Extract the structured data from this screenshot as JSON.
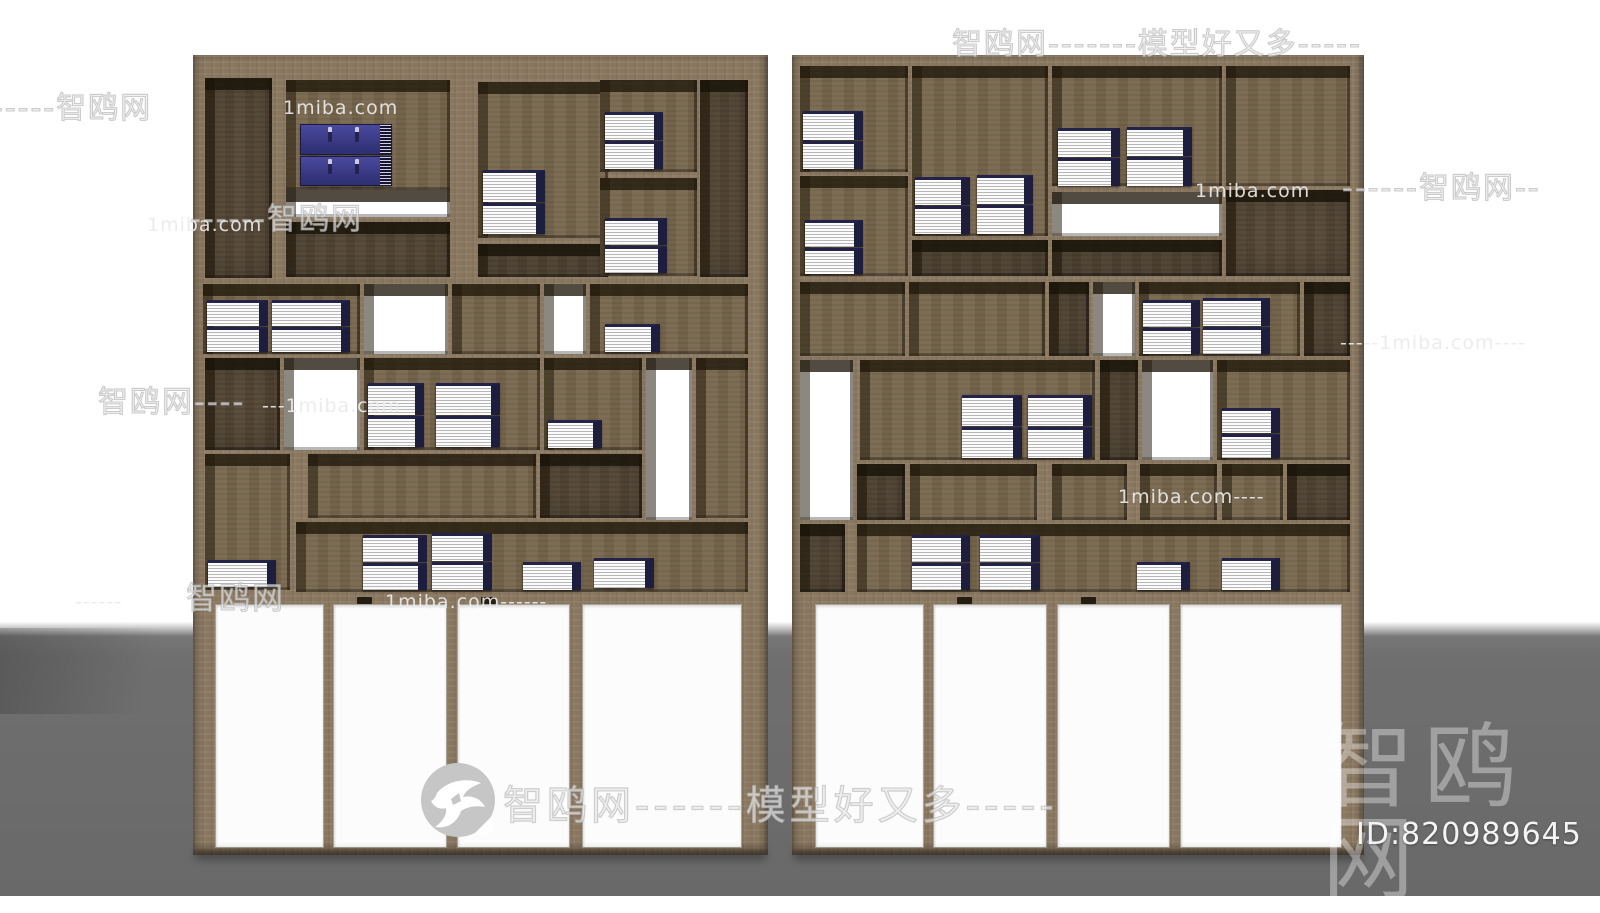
{
  "scene": {
    "width": 1600,
    "height": 896,
    "floor_top": 622,
    "colors": {
      "wall": "#ffffff",
      "floor": "#6f6f6f",
      "wood_frame": "#8c7a63",
      "wood_back": "#79684f",
      "wood_dark": "#5a4c3a",
      "book_cover_navy": "#1d1d3e",
      "book_pages": "#fbfbfb",
      "box_blue": "#35357e",
      "watermark_gray": "#ececec",
      "watermark_white": "#ffffff"
    }
  },
  "watermarks": {
    "outline": [
      {
        "x": 952,
        "y": 30,
        "size": 30,
        "text": "智鸥网-------模型好又多-----"
      },
      {
        "x": -8,
        "y": 94,
        "size": 30,
        "text": "-----智鸥网"
      },
      {
        "x": 1342,
        "y": 174,
        "size": 30,
        "text": "------智鸥网--"
      },
      {
        "x": 190,
        "y": 205,
        "size": 30,
        "text": "------智鸥网"
      },
      {
        "x": 98,
        "y": 388,
        "size": 30,
        "text": "智鸥网----"
      },
      {
        "x": 186,
        "y": 584,
        "size": 31,
        "text": "智鸥网"
      }
    ],
    "gray": [
      {
        "x": 283,
        "y": 99,
        "size": 19,
        "text": "1miba.com"
      },
      {
        "x": 147,
        "y": 216,
        "size": 19,
        "text": "1miba.com"
      },
      {
        "x": 1195,
        "y": 182,
        "size": 19,
        "text": "1miba.com"
      },
      {
        "x": 1340,
        "y": 334,
        "size": 19,
        "text": "-----1miba.com----"
      },
      {
        "x": 262,
        "y": 397,
        "size": 19,
        "text": "---1miba.com"
      },
      {
        "x": 1118,
        "y": 488,
        "size": 19,
        "text": "1miba.com----"
      },
      {
        "x": 75,
        "y": 593,
        "size": 19,
        "text": "------"
      },
      {
        "x": 385,
        "y": 593,
        "size": 19,
        "text": "1miba.com------"
      }
    ],
    "badge": {
      "x": 421,
      "y": 763,
      "diameter": 74,
      "text_size": 40,
      "text": "智鸥网------模型好又多-----"
    },
    "footer": {
      "logo_text": "智鸥网",
      "logo_x": 1322,
      "logo_y": 722,
      "logo_size": 92,
      "id_text": "ID:820989645",
      "id_x": 1356,
      "id_y": 820,
      "id_size": 30
    }
  },
  "shelves": [
    {
      "name": "left-shelf",
      "x": 193,
      "y": 55,
      "w": 575,
      "h": 800,
      "compartments": [
        {
          "x": 12,
          "y": 23,
          "w": 67,
          "h": 200,
          "back": "dark"
        },
        {
          "x": 93,
          "y": 25,
          "w": 164,
          "h": 110,
          "back": "wood",
          "items": [
            {
              "t": "boxes2",
              "x": 14,
              "y": 44,
              "w": 92,
              "h": 62
            }
          ]
        },
        {
          "x": 93,
          "y": 135,
          "w": 164,
          "h": 27,
          "back": "white"
        },
        {
          "x": 93,
          "y": 167,
          "w": 164,
          "h": 55,
          "back": "dark"
        },
        {
          "x": 285,
          "y": 27,
          "w": 130,
          "h": 156,
          "back": "wood",
          "items": [
            {
              "t": "books2",
              "x": 5,
              "y": 88,
              "w": 62,
              "h": 64
            }
          ]
        },
        {
          "x": 285,
          "y": 189,
          "w": 130,
          "h": 33,
          "back": "dark"
        },
        {
          "x": 407,
          "y": 25,
          "w": 97,
          "h": 92,
          "back": "wood",
          "items": [
            {
              "t": "books2",
              "x": 5,
              "y": 32,
              "w": 58,
              "h": 57
            }
          ]
        },
        {
          "x": 407,
          "y": 123,
          "w": 97,
          "h": 98,
          "back": "wood",
          "items": [
            {
              "t": "books2",
              "x": 5,
              "y": 40,
              "w": 62,
              "h": 55
            }
          ]
        },
        {
          "x": 507,
          "y": 25,
          "w": 48,
          "h": 197,
          "back": "dark"
        },
        {
          "x": 10,
          "y": 229,
          "w": 157,
          "h": 70,
          "back": "wood",
          "items": [
            {
              "t": "books2",
              "x": 4,
              "y": 16,
              "w": 61,
              "h": 52
            },
            {
              "t": "books2",
              "x": 69,
              "y": 16,
              "w": 78,
              "h": 52
            }
          ]
        },
        {
          "x": 171,
          "y": 229,
          "w": 84,
          "h": 70,
          "back": "white"
        },
        {
          "x": 259,
          "y": 229,
          "w": 88,
          "h": 70,
          "back": "wood"
        },
        {
          "x": 351,
          "y": 229,
          "w": 42,
          "h": 70,
          "back": "white"
        },
        {
          "x": 397,
          "y": 229,
          "w": 158,
          "h": 70,
          "back": "wood",
          "items": [
            {
              "t": "books1",
              "x": 15,
              "y": 40,
              "w": 55,
              "h": 28
            }
          ]
        },
        {
          "x": 12,
          "y": 303,
          "w": 75,
          "h": 92,
          "back": "dark"
        },
        {
          "x": 91,
          "y": 303,
          "w": 76,
          "h": 92,
          "back": "white"
        },
        {
          "x": 171,
          "y": 303,
          "w": 176,
          "h": 92,
          "back": "wood",
          "items": [
            {
              "t": "books2",
              "x": 4,
              "y": 25,
              "w": 56,
              "h": 64
            },
            {
              "t": "books2",
              "x": 72,
              "y": 25,
              "w": 64,
              "h": 64
            }
          ]
        },
        {
          "x": 351,
          "y": 303,
          "w": 98,
          "h": 92,
          "back": "wood",
          "items": [
            {
              "t": "books1",
              "x": 4,
              "y": 62,
              "w": 54,
              "h": 28
            }
          ]
        },
        {
          "x": 453,
          "y": 303,
          "w": 46,
          "h": 162,
          "back": "white"
        },
        {
          "x": 503,
          "y": 303,
          "w": 52,
          "h": 160,
          "back": "wood"
        },
        {
          "x": 12,
          "y": 399,
          "w": 85,
          "h": 136,
          "back": "wood",
          "items": [
            {
              "t": "books1",
              "x": 3,
              "y": 106,
              "w": 68,
              "h": 27
            }
          ]
        },
        {
          "x": 115,
          "y": 399,
          "w": 228,
          "h": 64,
          "back": "wood"
        },
        {
          "x": 347,
          "y": 399,
          "w": 102,
          "h": 64,
          "back": "dark"
        },
        {
          "x": 103,
          "y": 467,
          "w": 452,
          "h": 70,
          "back": "wood",
          "items": [
            {
              "t": "books2",
              "x": 67,
              "y": 13,
              "w": 64,
              "h": 55
            },
            {
              "t": "books2",
              "x": 136,
              "y": 11,
              "w": 60,
              "h": 57
            },
            {
              "t": "books1",
              "x": 227,
              "y": 40,
              "w": 58,
              "h": 28
            },
            {
              "t": "books1",
              "x": 298,
              "y": 36,
              "w": 60,
              "h": 30
            }
          ]
        }
      ],
      "doors": {
        "y": 537,
        "h": 263,
        "panels": [
          {
            "x": 22,
            "w": 107
          },
          {
            "x": 140,
            "w": 112
          },
          {
            "x": 264,
            "w": 111
          },
          {
            "x": 389,
            "w": 158
          }
        ],
        "notch_panels": [
          1,
          2
        ]
      }
    },
    {
      "name": "right-shelf",
      "x": 792,
      "y": 55,
      "w": 572,
      "h": 800,
      "compartments": [
        {
          "x": 8,
          "y": 11,
          "w": 108,
          "h": 106,
          "back": "wood",
          "items": [
            {
              "t": "books2",
              "x": 3,
              "y": 45,
              "w": 60,
              "h": 58
            }
          ]
        },
        {
          "x": 8,
          "y": 121,
          "w": 108,
          "h": 100,
          "back": "wood",
          "items": [
            {
              "t": "books2",
              "x": 5,
              "y": 44,
              "w": 58,
              "h": 54
            }
          ]
        },
        {
          "x": 120,
          "y": 11,
          "w": 136,
          "h": 170,
          "back": "wood",
          "items": [
            {
              "t": "books2",
              "x": 3,
              "y": 111,
              "w": 55,
              "h": 57
            },
            {
              "t": "books2",
              "x": 65,
              "y": 109,
              "w": 56,
              "h": 59
            }
          ]
        },
        {
          "x": 120,
          "y": 185,
          "w": 136,
          "h": 36,
          "back": "dark"
        },
        {
          "x": 260,
          "y": 11,
          "w": 170,
          "h": 120,
          "back": "wood",
          "items": [
            {
              "t": "books2",
              "x": 6,
              "y": 62,
              "w": 62,
              "h": 58
            },
            {
              "t": "books2",
              "x": 75,
              "y": 61,
              "w": 65,
              "h": 59
            }
          ]
        },
        {
          "x": 260,
          "y": 137,
          "w": 170,
          "h": 44,
          "back": "white"
        },
        {
          "x": 260,
          "y": 185,
          "w": 170,
          "h": 36,
          "back": "dark"
        },
        {
          "x": 434,
          "y": 11,
          "w": 124,
          "h": 120,
          "back": "wood"
        },
        {
          "x": 434,
          "y": 135,
          "w": 124,
          "h": 86,
          "back": "dark"
        },
        {
          "x": 8,
          "y": 227,
          "w": 105,
          "h": 74,
          "back": "wood"
        },
        {
          "x": 117,
          "y": 227,
          "w": 136,
          "h": 74,
          "back": "wood"
        },
        {
          "x": 257,
          "y": 227,
          "w": 40,
          "h": 74,
          "back": "dark"
        },
        {
          "x": 301,
          "y": 227,
          "w": 42,
          "h": 74,
          "back": "white"
        },
        {
          "x": 347,
          "y": 227,
          "w": 161,
          "h": 74,
          "back": "wood",
          "items": [
            {
              "t": "books2",
              "x": 4,
              "y": 18,
              "w": 57,
              "h": 54
            },
            {
              "t": "books2",
              "x": 64,
              "y": 16,
              "w": 67,
              "h": 56
            }
          ]
        },
        {
          "x": 512,
          "y": 227,
          "w": 46,
          "h": 74,
          "back": "dark"
        },
        {
          "x": 8,
          "y": 305,
          "w": 53,
          "h": 160,
          "back": "white"
        },
        {
          "x": 68,
          "y": 305,
          "w": 235,
          "h": 100,
          "back": "wood",
          "items": [
            {
              "t": "books2",
              "x": 102,
              "y": 35,
              "w": 60,
              "h": 63
            },
            {
              "t": "books2",
              "x": 168,
              "y": 35,
              "w": 64,
              "h": 63
            }
          ]
        },
        {
          "x": 308,
          "y": 305,
          "w": 38,
          "h": 100,
          "back": "dark"
        },
        {
          "x": 350,
          "y": 305,
          "w": 71,
          "h": 100,
          "back": "white"
        },
        {
          "x": 425,
          "y": 305,
          "w": 133,
          "h": 100,
          "back": "wood",
          "items": [
            {
              "t": "books2",
              "x": 5,
              "y": 48,
              "w": 58,
              "h": 50
            }
          ]
        },
        {
          "x": 65,
          "y": 409,
          "w": 48,
          "h": 56,
          "back": "dark"
        },
        {
          "x": 118,
          "y": 409,
          "w": 127,
          "h": 56,
          "back": "wood"
        },
        {
          "x": 260,
          "y": 409,
          "w": 75,
          "h": 56,
          "back": "wood"
        },
        {
          "x": 348,
          "y": 409,
          "w": 77,
          "h": 56,
          "back": "wood"
        },
        {
          "x": 430,
          "y": 409,
          "w": 61,
          "h": 56,
          "back": "wood"
        },
        {
          "x": 495,
          "y": 409,
          "w": 63,
          "h": 56,
          "back": "dark"
        },
        {
          "x": 8,
          "y": 469,
          "w": 45,
          "h": 68,
          "back": "dark"
        },
        {
          "x": 65,
          "y": 469,
          "w": 493,
          "h": 68,
          "back": "wood",
          "items": [
            {
              "t": "books2",
              "x": 55,
              "y": 11,
              "w": 58,
              "h": 55
            },
            {
              "t": "books2",
              "x": 123,
              "y": 11,
              "w": 60,
              "h": 55
            },
            {
              "t": "books1",
              "x": 280,
              "y": 38,
              "w": 53,
              "h": 28
            },
            {
              "t": "books1",
              "x": 365,
              "y": 34,
              "w": 58,
              "h": 32
            }
          ]
        }
      ],
      "doors": {
        "y": 537,
        "h": 263,
        "panels": [
          {
            "x": 23,
            "w": 107
          },
          {
            "x": 141,
            "w": 112
          },
          {
            "x": 265,
            "w": 111
          },
          {
            "x": 388,
            "w": 160
          }
        ],
        "notch_panels": [
          1,
          2
        ]
      }
    }
  ]
}
